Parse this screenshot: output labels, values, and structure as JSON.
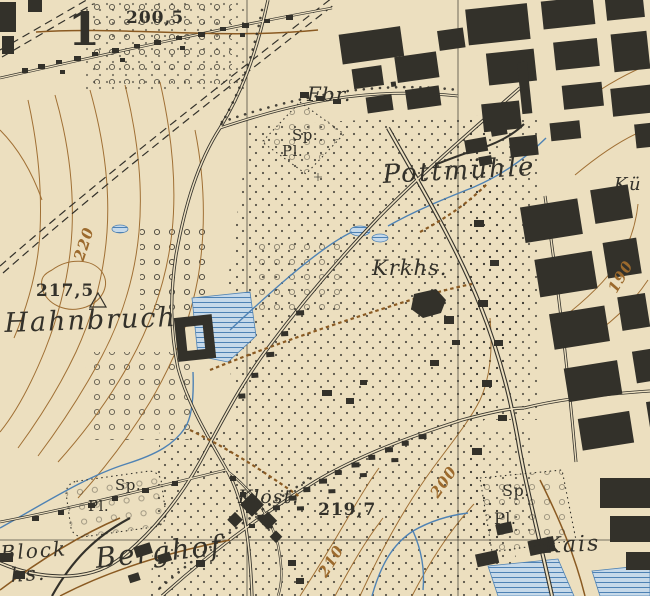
{
  "map": {
    "colors": {
      "paper": "#ecdfbf",
      "ink": "#33312a",
      "contour": "#9c6a2d",
      "water": "#4e82b4",
      "waterfill": "#c6d9e9",
      "track": "#8a5a22"
    },
    "labels": {
      "grid_number": {
        "text": "1"
      },
      "spot_height_top": {
        "text": "200,5"
      },
      "factory_abbr": {
        "text": "Fbr."
      },
      "sports_top": {
        "text": "Sp."
      },
      "place_top": {
        "text": "Pl."
      },
      "pottmuehle": {
        "text": "Pottmühle"
      },
      "hospital_abbr": {
        "text": "Krkhs."
      },
      "contour_220": {
        "text": "220"
      },
      "spot_height_west": {
        "text": "217,5"
      },
      "hahnbruch": {
        "text": "Hahnbruch"
      },
      "contour_190": {
        "text": "190"
      },
      "contour_200": {
        "text": "200"
      },
      "contour_210": {
        "text": "210"
      },
      "kloster_abbr": {
        "text": "Klost."
      },
      "spot_height_south": {
        "text": "219,7"
      },
      "sports_southwest": {
        "text": "Sp."
      },
      "place_southwest": {
        "text": "Pl."
      },
      "sports_southeast": {
        "text": "Sp."
      },
      "place_southeast": {
        "text": "Pl."
      },
      "blockhouse_line1": {
        "text": "Block"
      },
      "blockhouse_line2": {
        "text": "hs."
      },
      "berghof": {
        "text": "Berghof"
      },
      "kais": {
        "text": "Kais"
      },
      "kue": {
        "text": "Kü"
      }
    }
  }
}
